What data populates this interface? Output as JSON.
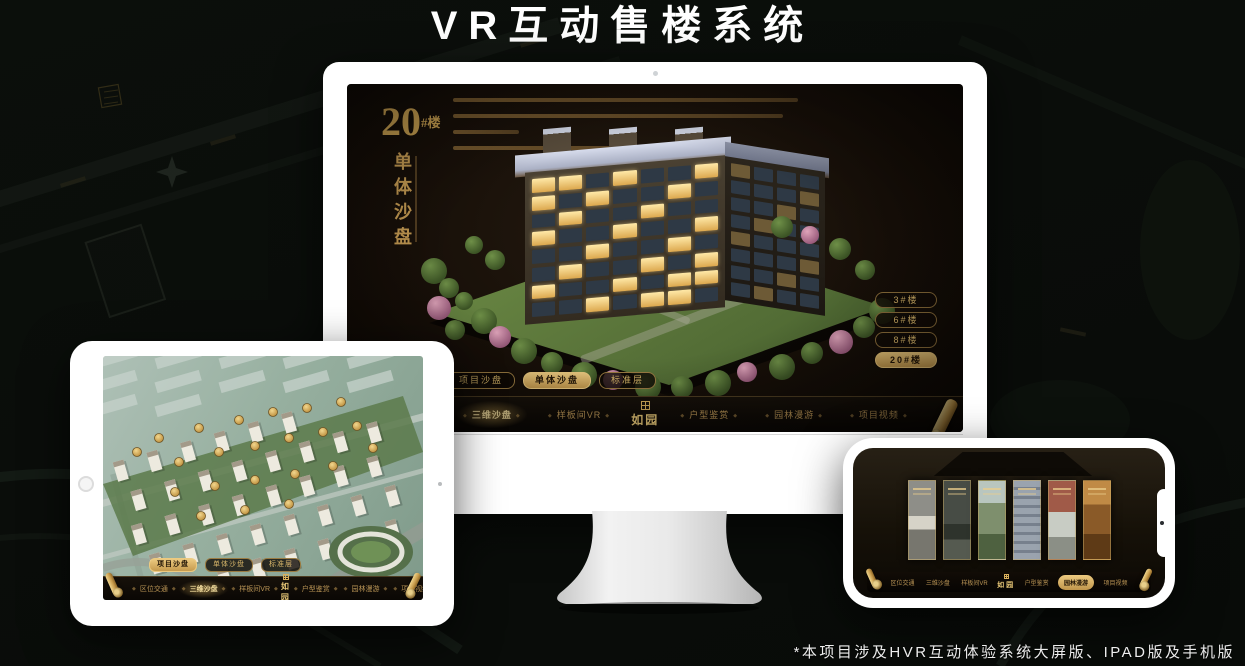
{
  "page": {
    "title": "VR互动售楼系统",
    "footer_note": "*本项目涉及HVR互动体验系统大屏版、IPAD版及手机版"
  },
  "colors": {
    "gold": "#c9a35a",
    "gold_bright": "#e6c87c",
    "gold_deep": "#8a6a30",
    "screen_bg": "#16100a",
    "page_bg": "#0a0d0b"
  },
  "app": {
    "logo": "如园",
    "view_tabs": [
      {
        "label": "项目沙盘"
      },
      {
        "label": "单体沙盘"
      },
      {
        "label": "标准层"
      }
    ],
    "nav_items": [
      {
        "label": "区位交通"
      },
      {
        "label": "三维沙盘"
      },
      {
        "label": "样板间VR"
      },
      {
        "label": "户型鉴赏"
      },
      {
        "label": "园林漫游"
      },
      {
        "label": "项目视频"
      }
    ]
  },
  "desktop": {
    "building_number": "20",
    "building_number_suffix": "#楼",
    "view_title_vertical": "单体沙盘",
    "floor_buttons": [
      {
        "label": "3#楼"
      },
      {
        "label": "6#楼"
      },
      {
        "label": "8#楼"
      },
      {
        "label": "20#楼",
        "selected": true
      }
    ],
    "active_view_tab": 1,
    "active_nav_item": 1
  },
  "ipad": {
    "active_view_tab": 0,
    "active_nav_item": 1
  },
  "phone": {
    "active_nav_item": 4
  }
}
